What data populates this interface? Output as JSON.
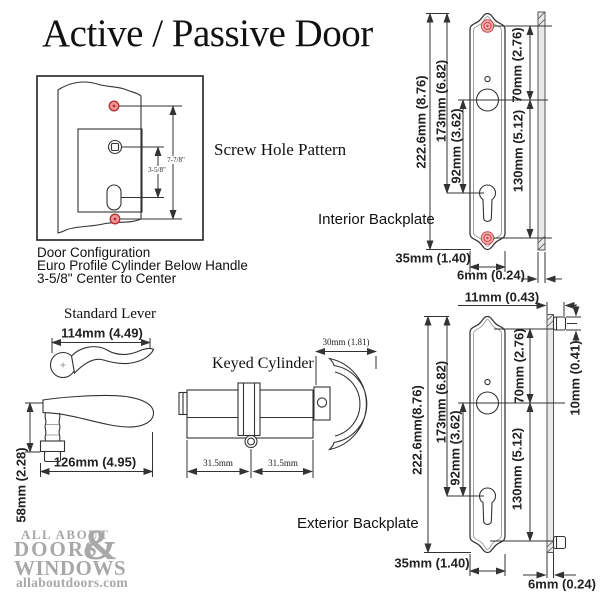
{
  "title": "Active / Passive Door",
  "screw_hole_pattern": {
    "label": "Screw Hole Pattern",
    "dim_outer": "7-7/8\"",
    "dim_inner": "3-5/8\""
  },
  "door_configuration": {
    "line1": "Door Configuration",
    "line2": "Euro Profile Cylinder Below Handle",
    "line3": "3-5/8\" Center to Center"
  },
  "standard_lever": {
    "label": "Standard Lever",
    "top_width": "114mm (4.49)",
    "side_width": "126mm (4.95)",
    "side_height": "58mm (2.28)"
  },
  "keyed_cylinder": {
    "label": "Keyed Cylinder",
    "left_half": "31.5mm",
    "right_half": "31.5mm",
    "thumbturn_width": "30mm (1.81)"
  },
  "interior_backplate": {
    "label": "Interior Backplate",
    "overall_height": "222.6mm (8.76)",
    "top_to_cylinder": "173mm (6.82)",
    "handle_to_cylinder": "92mm (3.62)",
    "screw_to_handle": "70mm (2.76)",
    "handle_to_screw": "130mm (5.12)",
    "width": "35mm (1.40)",
    "thickness": "6mm (0.24)"
  },
  "exterior_backplate": {
    "label": "Exterior Backplate",
    "overall_height": "222.6mm(8.76)",
    "top_to_cylinder": "173mm (6.82)",
    "handle_to_cylinder": "92mm (3.62)",
    "screw_to_handle": "70mm (2.76)",
    "handle_to_screw": "130mm (5.12)",
    "width": "35mm (1.40)",
    "thickness": "6mm (0.24)",
    "total_depth": "11mm (0.43)",
    "boss_depth": "10mm (0.41)"
  },
  "logo": {
    "line1": "ALL ABOUT",
    "line2": "DOORS",
    "ampersand": "&",
    "line3": "WINDOWS",
    "website": "allaboutdoors.com"
  },
  "colors": {
    "line": "#333333",
    "screw_red": "#e05050",
    "logo_gray": "#a8a8a8",
    "background": "#ffffff"
  }
}
